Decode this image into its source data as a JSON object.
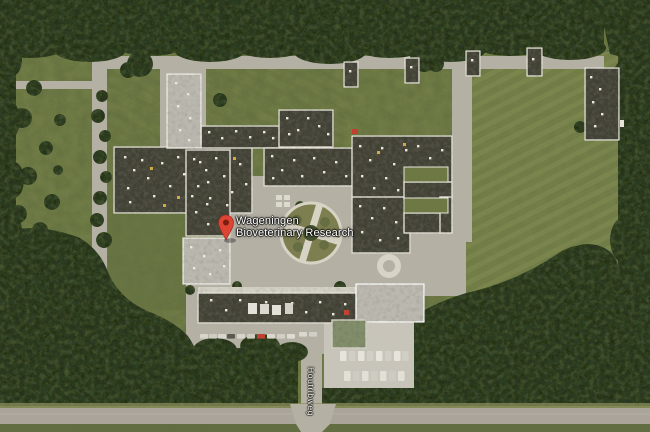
{
  "map": {
    "labels": {
      "place": {
        "line1": "Wageningen",
        "line2": "Bioveterinary Research"
      },
      "street": "Houtribweg"
    },
    "marker": {
      "icon": "map-pin-icon",
      "color": "#de4434",
      "inner_color": "#7c1d12"
    }
  },
  "palette": {
    "field": "#68743d",
    "fieldLight": "#79854a",
    "fieldDark": "#5c693a",
    "forest": "#2b3a22",
    "forestDark": "#141f0c",
    "forestLight": "#4e5e31",
    "concrete": "#b3afa3",
    "concreteLight": "#c8c4b9",
    "roofDark": "#3e3c33",
    "roofLight": "#bcb9b0",
    "trim": "#e9e7dd",
    "road": "#a9a399",
    "greenRoof": "#7e8b66",
    "pin": "#de4434",
    "pinInner": "#7c1d12",
    "labelText": "#ffffff"
  }
}
